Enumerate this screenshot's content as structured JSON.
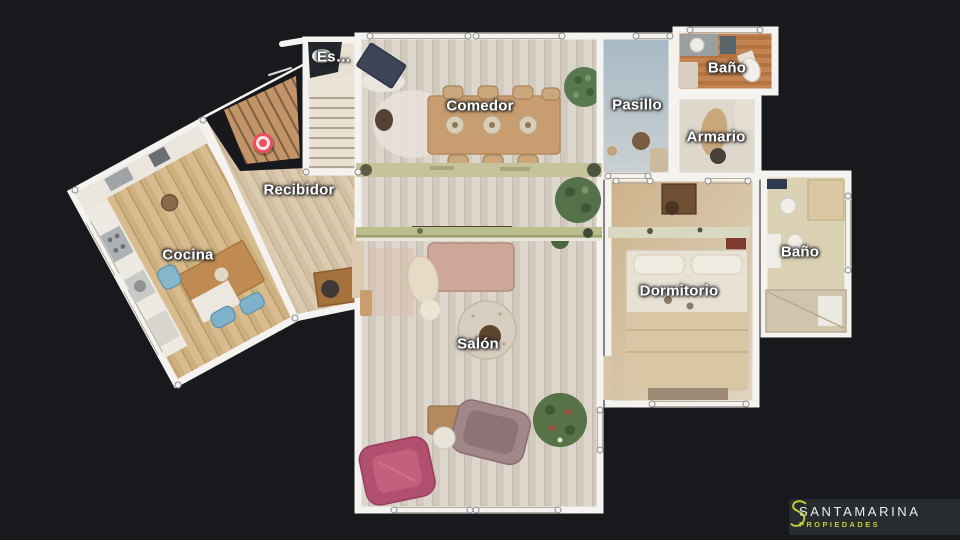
{
  "app": {
    "view": "3d-floorplan"
  },
  "colors": {
    "background": "#17191d",
    "wall": "#f5f3ef",
    "marker_red": "#ee4e62",
    "brand_green": "#bfcf3a",
    "brand_panel": "#282c2f"
  },
  "rooms": [
    {
      "id": "escalera",
      "label": "Es…",
      "label_x": 334,
      "label_y": 57
    },
    {
      "id": "comedor",
      "label": "Comedor",
      "label_x": 480,
      "label_y": 106
    },
    {
      "id": "bano-superior",
      "label": "Baño",
      "label_x": 727,
      "label_y": 68
    },
    {
      "id": "pasillo",
      "label": "Pasillo",
      "label_x": 637,
      "label_y": 105
    },
    {
      "id": "armario",
      "label": "Armario",
      "label_x": 716,
      "label_y": 137
    },
    {
      "id": "recibidor",
      "label": "Recibidor",
      "label_x": 299,
      "label_y": 190
    },
    {
      "id": "cocina",
      "label": "Cocina",
      "label_x": 188,
      "label_y": 255
    },
    {
      "id": "bano-derecho",
      "label": "Baño",
      "label_x": 800,
      "label_y": 252
    },
    {
      "id": "dormitorio",
      "label": "Dormitorio",
      "label_x": 679,
      "label_y": 291
    },
    {
      "id": "salon",
      "label": "Salón",
      "label_x": 478,
      "label_y": 344
    }
  ],
  "marker": {
    "icon": "position-marker-icon",
    "color": "#ee4e62"
  },
  "brand": {
    "icon": "s-logo-icon",
    "name": "SANTAMARINA",
    "tagline": "PROPIEDADES"
  }
}
